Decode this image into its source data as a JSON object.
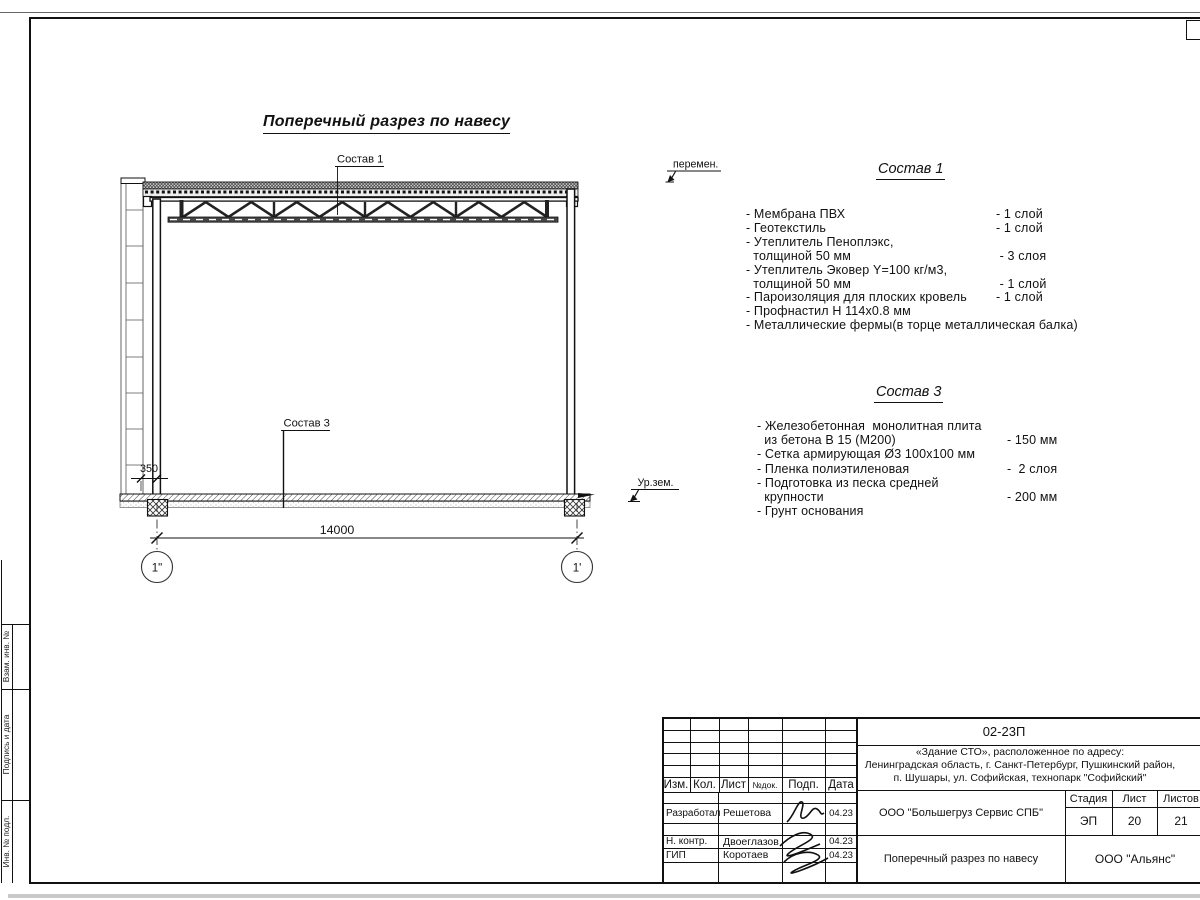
{
  "drawing": {
    "title": "Поперечный разрез по навесу",
    "callout_sostav1": "Состав 1",
    "callout_sostav3": "Состав 3",
    "dim_main": "14000",
    "dim_offset": "350",
    "axis_left": "1\"",
    "axis_right": "1'",
    "level_variable": "перемен.",
    "level_ground": "Ур.зем."
  },
  "sostav1": {
    "heading": "Состав 1",
    "rows": [
      {
        "text": "- Мембрана ПВХ",
        "value": "- 1 слой"
      },
      {
        "text": "- Геотекстиль",
        "value": "- 1 слой"
      },
      {
        "text": "- Утеплитель Пеноплэкс,",
        "value": ""
      },
      {
        "text": "  толщиной 50 мм",
        "value": " - 3 слоя"
      },
      {
        "text": "- Утеплитель Эковер Y=100 кг/м3,",
        "value": ""
      },
      {
        "text": "  толщиной 50 мм",
        "value": " - 1 слой"
      },
      {
        "text": "- Пароизоляция для плоских кровель",
        "value": "- 1 слой"
      },
      {
        "text": "- Профнастил Н 114х0.8 мм",
        "value": ""
      },
      {
        "text": "- Металлические фермы(в торце металлическая балка)",
        "value": ""
      }
    ]
  },
  "sostav3": {
    "heading": "Состав 3",
    "rows": [
      {
        "text": "- Железобетонная  монолитная плита",
        "value": ""
      },
      {
        "text": "  из бетона В 15 (М200)",
        "value": "- 150 мм"
      },
      {
        "text": "- Сетка армирующая Ø3 100х100 мм",
        "value": ""
      },
      {
        "text": "- Пленка полиэтиленовая",
        "value": "-  2 слоя"
      },
      {
        "text": "- Подготовка из песка средней",
        "value": ""
      },
      {
        "text": "  крупности",
        "value": "- 200 мм"
      },
      {
        "text": "- Грунт основания",
        "value": ""
      }
    ]
  },
  "titleblock": {
    "doc_number": "02-23П",
    "object_line1": "«Здание СТО», расположенное по адресу:",
    "object_line2": "Ленинградская область, г. Санкт-Петербург, Пушкинский район,",
    "object_line3": "п. Шушары, ул. Софийская, технопарк \"Софийский\"",
    "col_izm": "Изм.",
    "col_kol": "Кол.",
    "col_list": "Лист",
    "col_doc": "№док.",
    "col_podp": "Подп.",
    "col_data": "Дата",
    "row1_role": "Разработал",
    "row1_name": "Решетова",
    "row1_date": "04.23",
    "row2_role": "Н. контр.",
    "row2_name": "Двоеглазов",
    "row2_date": "04.23",
    "row3_role": "ГИП",
    "row3_name": "Коротаев",
    "row3_date": "04.23",
    "company": "ООО \"Большегруз Сервис СПБ\"",
    "stage_label": "Стадия",
    "list_label": "Лист",
    "listov_label": "Листов",
    "stage": "ЭП",
    "list_num": "20",
    "listov_num": "21",
    "doc_title": "Поперечный разрез по навесу",
    "org": "ООО \"Альянс\""
  },
  "side_stamp": {
    "cell1": "Взам. инв. №",
    "cell2": "Подпись и дата",
    "cell3": "Инв. № подл."
  }
}
